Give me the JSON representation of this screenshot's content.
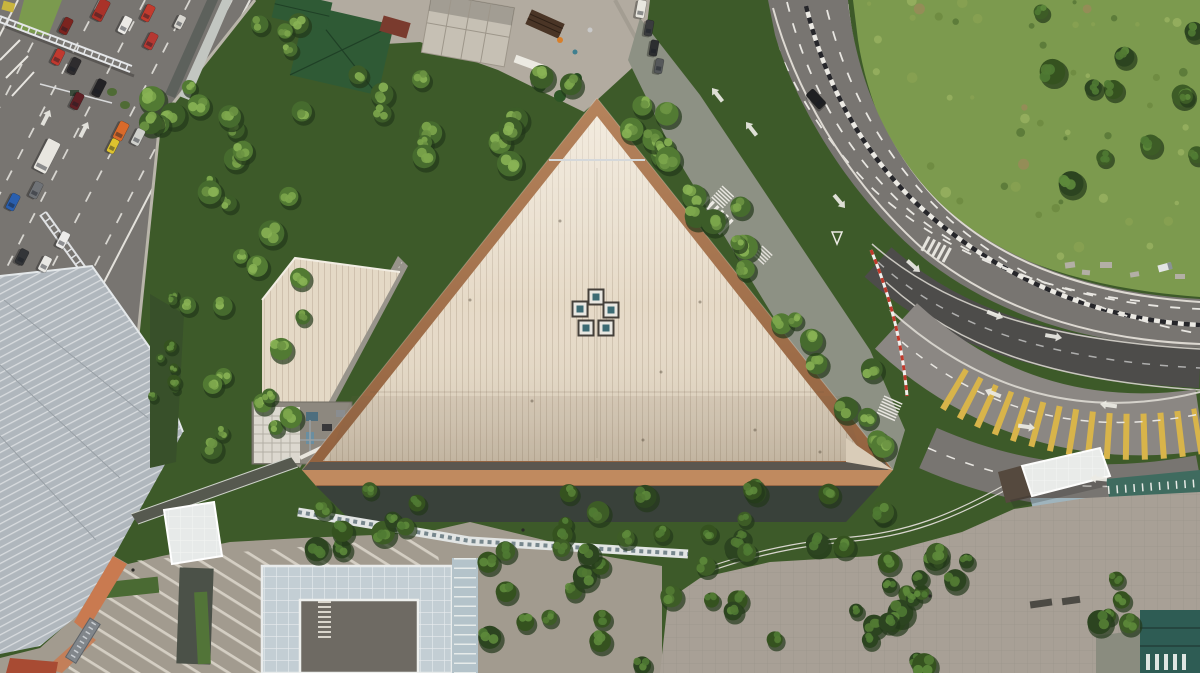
{
  "meta": {
    "type": "aerial-photograph",
    "view": "top-down drone view",
    "description": "Top-down aerial photo of a large triangular standing-seam roof with copper edging, flanked by a congested multi-lane road to the northwest, a curving multi-lane road wrapping a vegetated hillside to the east, dense tree canopy, a corrugated metal roof to the southwest, and a pedestrian plaza with glass canopies to the south."
  },
  "labels": {
    "scene": "Aerial view of triangular-roofed building complex",
    "main_roof": "Triangular standing-seam roof with copper edge",
    "annex_roof": "Annex roof wing",
    "roof_gap": "Gap walkway between roofs",
    "equipment_yard": "Rooftop equipment yard with cooling tower",
    "skylights": "Ring of five rooftop skylights",
    "nw_road": "Congested multi-lane road (northwest)",
    "crane": "Construction crane boom",
    "e_road": "Curved multi-lane road (east)",
    "hill": "Vegetated hillside slope",
    "construction": "Construction site",
    "gray_roof": "Corrugated metal roof building (southwest)",
    "plaza": "Pedestrian plaza with paving and canopies",
    "atrium": "Glass atrium building",
    "se_pavement": "Paved forecourt (southeast)",
    "teal_building": "Teal-roofed building (corner)",
    "trees": "Tree canopy"
  },
  "palette": {
    "forest_base": "#3d5a29",
    "roof_cream": "#e6dac7",
    "copper": "#a5744f",
    "copper_light": "#c08a5f",
    "road": "#787571",
    "road_dark": "#4d4c4a",
    "road_light": "#8b8783",
    "marking": "#eceae4",
    "lane_yellow": "#d8b44a",
    "hill": "#7c9a4e",
    "metal_roof": "#b0b7bd",
    "plaza": "#a29b8f",
    "pavement": "#a8a096",
    "concrete": "#b2aba0",
    "glass": "#c3ced4",
    "dark_facade": "#39413a",
    "teal_roof": "#2e5c54",
    "orange_wall": "#c97a50",
    "green_roof": "#2f5a35",
    "gap_gray": "#98948b"
  },
  "vehicles": {
    "fields": "x,y,rotation,length,width,color",
    "items": [
      [
        101,
        10,
        117,
        22,
        11,
        "#a93229"
      ],
      [
        125,
        25,
        117,
        18,
        9,
        "#eceae6"
      ],
      [
        148,
        13,
        117,
        17,
        9,
        "#c23b2e"
      ],
      [
        151,
        41,
        117,
        17,
        9,
        "#b53832"
      ],
      [
        66,
        26,
        117,
        17,
        9,
        "#7c241f"
      ],
      [
        58,
        57,
        117,
        16,
        9,
        "#c0392f"
      ],
      [
        74,
        66,
        117,
        17,
        9,
        "#2e2c2e"
      ],
      [
        99,
        88,
        117,
        18,
        9,
        "#232225"
      ],
      [
        77,
        101,
        117,
        17,
        9,
        "#5f1f24"
      ],
      [
        121,
        131,
        117,
        19,
        10,
        "#d96a2a"
      ],
      [
        113,
        146,
        117,
        15,
        8,
        "#ddc22f"
      ],
      [
        138,
        137,
        117,
        17,
        9,
        "#cfd0cc"
      ],
      [
        47,
        156,
        117,
        34,
        14,
        "#e8e6e0"
      ],
      [
        36,
        190,
        117,
        17,
        9,
        "#6f7276"
      ],
      [
        13,
        202,
        117,
        17,
        9,
        "#2a5fae"
      ],
      [
        63,
        240,
        117,
        17,
        9,
        "#edecea"
      ],
      [
        22,
        257,
        117,
        16,
        9,
        "#333538"
      ],
      [
        45,
        264,
        117,
        16,
        9,
        "#e9e8e4"
      ],
      [
        180,
        22,
        117,
        14,
        8,
        "#d8d6d0"
      ],
      [
        816,
        99,
        47,
        20,
        10,
        "#1f2022"
      ],
      [
        649,
        28,
        100,
        16,
        8,
        "#3a3c3e"
      ],
      [
        654,
        48,
        100,
        16,
        8,
        "#2c2e30"
      ],
      [
        659,
        66,
        100,
        15,
        8,
        "#55585a"
      ],
      [
        641,
        9,
        100,
        18,
        9,
        "#e9e7df"
      ]
    ]
  },
  "road_arrows": {
    "fields": "x,y,direction_deg",
    "items": [
      [
        746,
        122,
        232
      ],
      [
        712,
        88,
        232
      ],
      [
        50,
        110,
        297
      ],
      [
        88,
        122,
        297
      ],
      [
        845,
        208,
        50
      ],
      [
        920,
        272,
        42
      ],
      [
        1003,
        318,
        22
      ],
      [
        1062,
        338,
        10
      ],
      [
        985,
        390,
        202
      ],
      [
        1100,
        404,
        188
      ],
      [
        1035,
        428,
        8
      ],
      [
        1090,
        478,
        185
      ]
    ]
  },
  "skylights": {
    "size": 15,
    "positions": [
      [
        596,
        297
      ],
      [
        580,
        309
      ],
      [
        611,
        310
      ],
      [
        586,
        328
      ],
      [
        606,
        328
      ]
    ]
  },
  "people": [
    [
      133,
      570
    ],
    [
      523,
      530
    ],
    [
      930,
      596
    ]
  ]
}
